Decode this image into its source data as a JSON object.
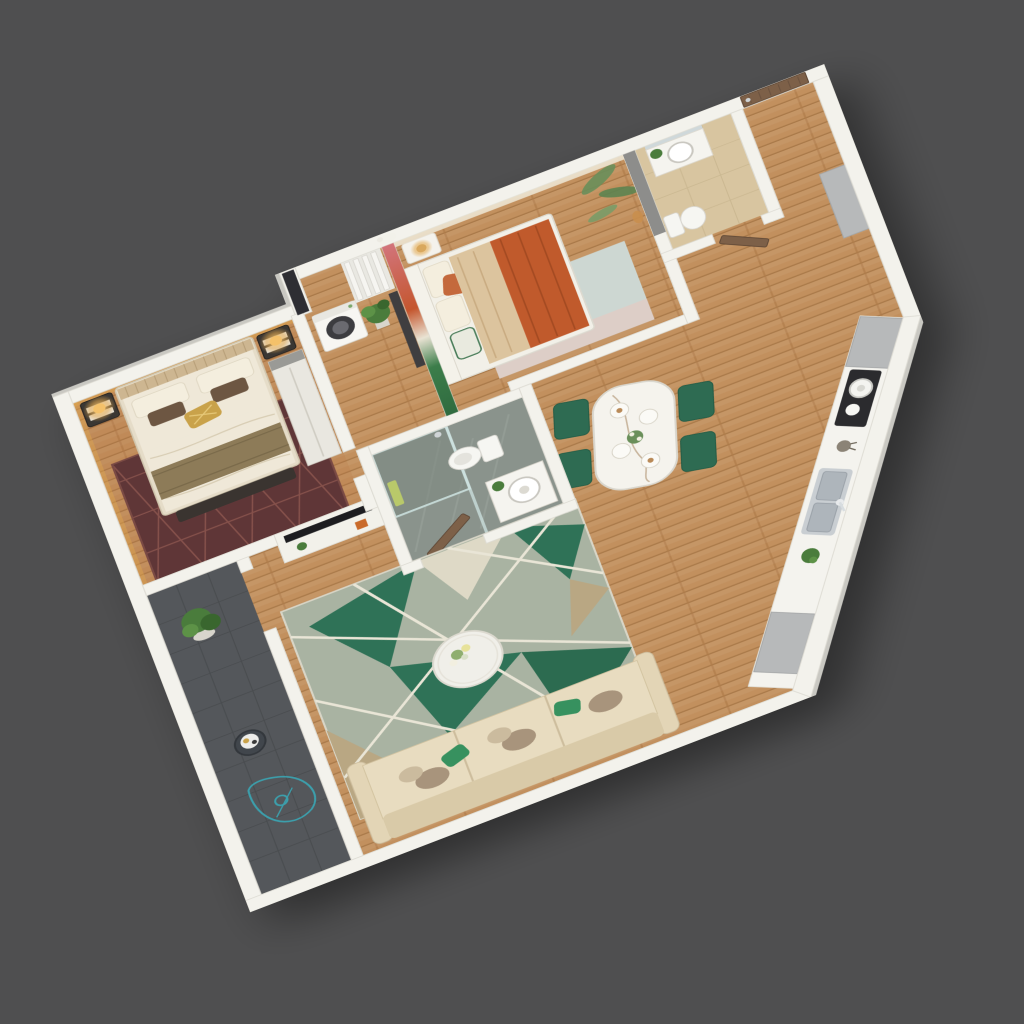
{
  "meta": {
    "title": "3D isometric cutaway floor plan render of a one-bedroom-plus apartment",
    "view": "axonometric top-down render on plain dark gray backdrop",
    "visible_text": "none"
  },
  "palette": {
    "background": "#4f4f50",
    "wall_top": "#f3f2ec",
    "wall_edge": "#c9c8c2",
    "wall_line": "#dedcd4",
    "wood_base": "#c2905e",
    "wood_seam": "#a87848",
    "master_floor_tint": "#b5713c",
    "master_rug": "#5f3637",
    "master_rug_line": "#8a544e",
    "bed_sheet": "#efe8d8",
    "duvet_fold": "#d8cdb4",
    "throw_olive": "#8d7b58",
    "pillow_white": "#f4eede",
    "pillow_brown": "#6d5642",
    "pillow_gold": "#c9a24a",
    "headboard": "#cdb691",
    "bench_dark": "#3a3430",
    "nightstand": "#3b3733",
    "lamp_glow": "#e2a84e",
    "wardrobe": "#e9e7e0",
    "window_dark": "#2e2e33",
    "mural_pink": "#d2747a",
    "mural_orange": "#c4562e",
    "mural_green": "#3c7d4a",
    "wallpaper_cream": "#ece4d2",
    "palm_green": "#6a8f5a",
    "leopard": "#c98f4e",
    "kids_blanket": "#c05a2c",
    "kids_beige": "#dcc49e",
    "kids_rug": "#cdd7d2",
    "kids_rug_pink": "#dfcdc5",
    "bath1_floor": "#8a938c",
    "shower_glass": "#cfe4e2",
    "towel_green": "#b9c96a",
    "porcelain": "#f6f6f2",
    "bath2_floor": "#d8c5a0",
    "bath2_wall_gray": "#8d8d8b",
    "door_wood": "#7d6048",
    "cabinet_gray": "#b7b9ba",
    "counter_white": "#f4f3ee",
    "sink_steel": "#c9ced2",
    "steel_dark": "#aeb5bb",
    "stove_black": "#2b2b2e",
    "chair_green": "#2e6b52",
    "table_marble": "#f5f3ed",
    "rug_sage": "#a9b3a2",
    "rug_emerald": "#2f7257",
    "rug_tan": "#b9a783",
    "rug_ivory": "#ded9c6",
    "rug_line": "#e9e5d6",
    "sofa_seat": "#e8dcc0",
    "sofa_back": "#d9caa8",
    "sofa_arm": "#e3d5b6",
    "pillow_taupe": "#a8947c",
    "pillow_green": "#37915f",
    "coffee_table": "#f0efe9",
    "balcony_floor": "#54575b",
    "balcony_grid": "#484b4e",
    "teal_outline": "#3aa7b5",
    "plant_green": "#4a7c3c",
    "plant_dark": "#39662e",
    "tv_black": "#1d1d20",
    "console_white": "#f2f1ea"
  },
  "rooms": {
    "master_bedroom": {
      "label": "Master bedroom",
      "items": [
        "double bed",
        "maroon diamond rug",
        "two dark nightstands with glowing lamps",
        "round wall decor",
        "wardrobe",
        "dark foot bench",
        "cove lighting"
      ]
    },
    "laundry_nook": {
      "label": "Laundry nook",
      "items": [
        "washing machine",
        "potted plant",
        "white radiator pipes",
        "dark partition",
        "elephant wall decor",
        "dark curtain slot"
      ]
    },
    "kids_bedroom": {
      "label": "Kids bedroom",
      "items": [
        "bed with orange blanket",
        "white nightstand with rattan lamp",
        "safari mural wall",
        "palm wallpaper with leopard",
        "pastel rug"
      ]
    },
    "bathroom_1": {
      "label": "Bathroom 1",
      "items": [
        "glass shower",
        "toilet",
        "round basin vanity",
        "green towel",
        "open wooden door"
      ]
    },
    "bathroom_2": {
      "label": "Bathroom 2",
      "items": [
        "vanity with round basin",
        "toilet",
        "plant",
        "beige tile floor",
        "open wooden door"
      ]
    },
    "entrance": {
      "label": "Entrance hall",
      "items": [
        "wooden entry door",
        "gray shoe cabinet"
      ]
    },
    "kitchen": {
      "label": "Kitchen",
      "items": [
        "white counter run",
        "double stainless sink",
        "black cooktop with pot and kettle",
        "utensil cup",
        "plant",
        "gray cabinets"
      ]
    },
    "dining_area": {
      "label": "Dining area",
      "items": [
        "marble dining table",
        "four emerald chairs",
        "place settings",
        "flower centerpiece"
      ]
    },
    "living_room": {
      "label": "Living room",
      "items": [
        "geometric green rug",
        "round marble coffee table with flowers",
        "cream three-seat sofa",
        "green and taupe pillows",
        "TV console divider"
      ]
    },
    "balcony": {
      "label": "Balcony",
      "items": [
        "dark tile floor",
        "potted plant",
        "round side table with tray",
        "teal outline floor drawing"
      ]
    }
  }
}
